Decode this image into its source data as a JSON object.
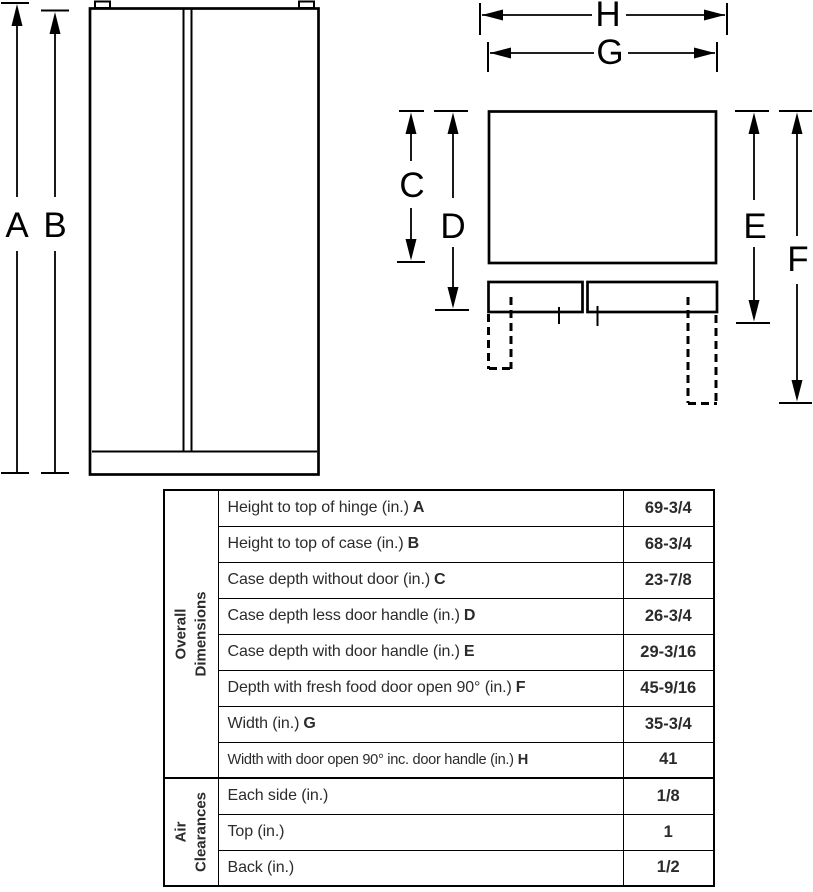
{
  "diagram": {
    "labels": {
      "a": "A",
      "b": "B",
      "c": "C",
      "d": "D",
      "e": "E",
      "f": "F",
      "g": "G",
      "h": "H"
    }
  },
  "table": {
    "sections": [
      {
        "label": "Overall\nDimensions",
        "rows": [
          {
            "label": "Height to top of hinge (in.)",
            "letter": "A",
            "value": "69-3/4"
          },
          {
            "label": "Height to top of case (in.)",
            "letter": "B",
            "value": "68-3/4"
          },
          {
            "label": "Case depth without door (in.)",
            "letter": "C",
            "value": "23-7/8"
          },
          {
            "label": "Case depth less door handle (in.)",
            "letter": "D",
            "value": "26-3/4"
          },
          {
            "label": "Case depth with door handle (in.)",
            "letter": "E",
            "value": "29-3/16"
          },
          {
            "label": "Depth with fresh food door open 90° (in.)",
            "letter": "F",
            "value": "45-9/16"
          },
          {
            "label": "Width (in.)",
            "letter": "G",
            "value": "35-3/4"
          },
          {
            "label": "Width with door open 90° inc. door handle (in.)",
            "letter": "H",
            "value": "41"
          }
        ]
      },
      {
        "label": "Air\nClearances",
        "rows": [
          {
            "label": "Each side (in.)",
            "value": "1/8"
          },
          {
            "label": "Top (in.)",
            "value": "1"
          },
          {
            "label": "Back (in.)",
            "value": "1/2"
          }
        ]
      }
    ]
  }
}
